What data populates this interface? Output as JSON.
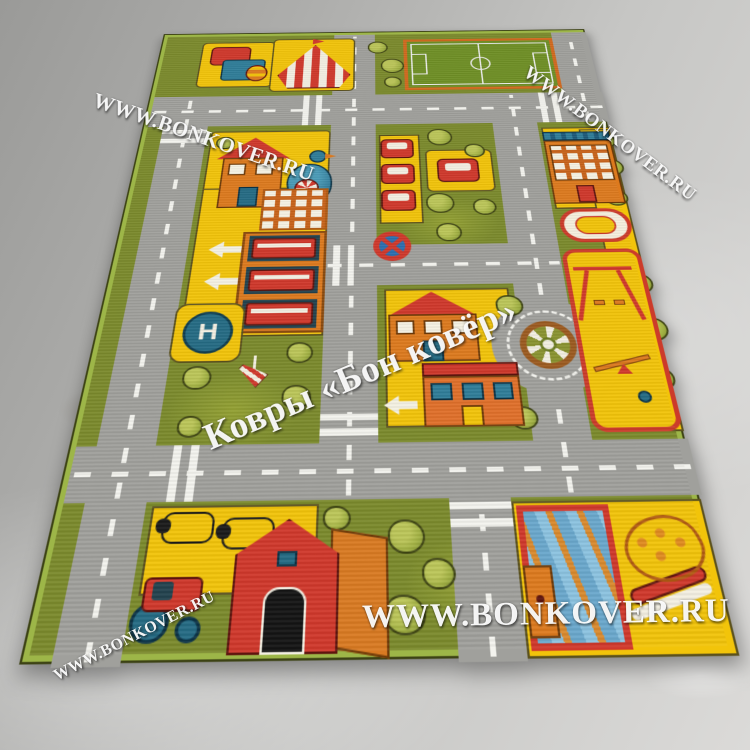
{
  "watermarks": {
    "brand_url": "WWW.BONKOVER.RU",
    "brand_title": "Ковры «Бон ковёр»"
  },
  "rug": {
    "description": "children city road play rug",
    "helipad_letter": "H"
  },
  "colors": {
    "grass": "#7b8a2c",
    "road": "#a0a09c",
    "roadDash": "#f3f3ee",
    "yellow": "#f2c40a",
    "red": "#d0382b",
    "orange": "#dd7a1e",
    "blue": "#2f7d99",
    "teal": "#256b84",
    "treeFill": "#a3b244",
    "fieldGreen": "#6f8f25",
    "rugEdge": "#9db648",
    "floorLight": "#dbdad8",
    "floorDark": "#9a9a98"
  }
}
